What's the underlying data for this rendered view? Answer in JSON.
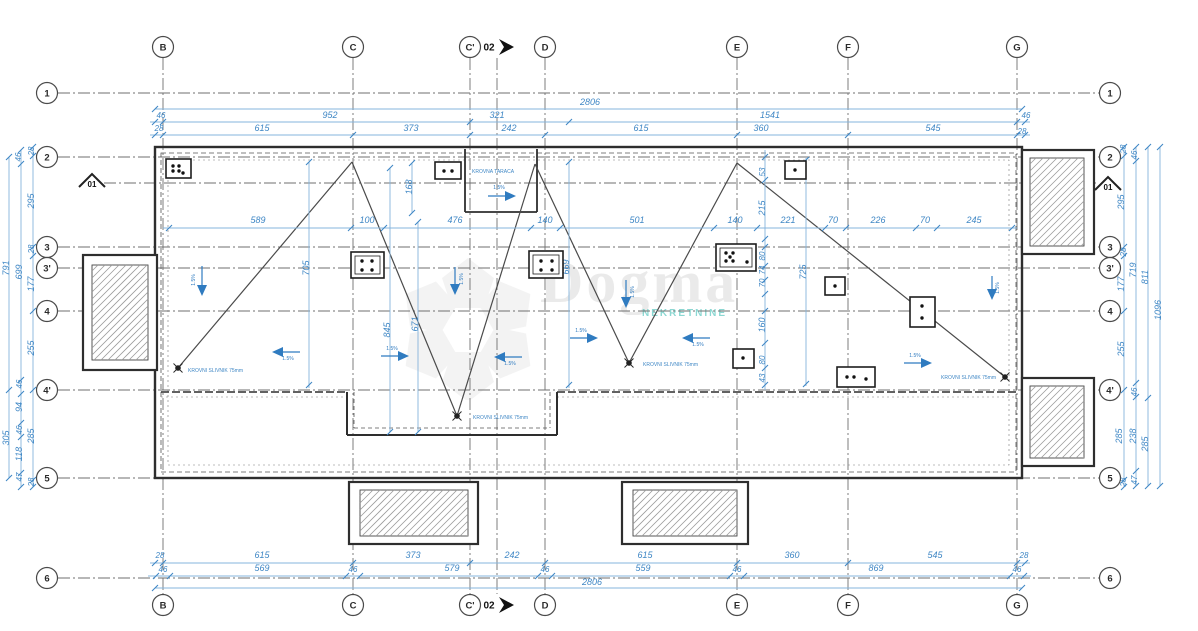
{
  "watermark": {
    "text": "Dogma",
    "subtext": "NEKRETNINE"
  },
  "markers": {
    "section_label": "02",
    "elevation_label": "01",
    "slope_label": "1.5%"
  },
  "colors": {
    "dim_text": "#3f87c5",
    "dim_line": "#85b4dc",
    "arrow": "#2f7bc0",
    "outline": "#2e2e2e",
    "grid": "#6f6f6f",
    "hatch": "#9a9a9a"
  },
  "grid": {
    "columns": [
      {
        "label": "B",
        "x": 163
      },
      {
        "label": "C",
        "x": 353
      },
      {
        "label": "C'",
        "x": 470
      },
      {
        "label": "D",
        "x": 545
      },
      {
        "label": "E",
        "x": 737
      },
      {
        "label": "F",
        "x": 848
      },
      {
        "label": "G",
        "x": 1017
      }
    ],
    "rows": [
      {
        "label": "1",
        "y": 93
      },
      {
        "label": "2",
        "y": 157
      },
      {
        "label": "3",
        "y": 247
      },
      {
        "label": "3'",
        "y": 268
      },
      {
        "label": "4",
        "y": 311
      },
      {
        "label": "4'",
        "y": 390
      },
      {
        "label": "5",
        "y": 478
      },
      {
        "label": "6",
        "y": 578
      }
    ]
  },
  "dimension_labels": [
    {
      "t": "2806",
      "x": 590,
      "y": 105
    },
    {
      "t": "46",
      "x": 161,
      "y": 118,
      "s": 8
    },
    {
      "t": "952",
      "x": 330,
      "y": 118
    },
    {
      "t": "321",
      "x": 497,
      "y": 118
    },
    {
      "t": "1541",
      "x": 770,
      "y": 118
    },
    {
      "t": "46",
      "x": 1026,
      "y": 118,
      "s": 8
    },
    {
      "t": "28",
      "x": 159,
      "y": 131,
      "s": 8
    },
    {
      "t": "615",
      "x": 262,
      "y": 131
    },
    {
      "t": "373",
      "x": 411,
      "y": 131
    },
    {
      "t": "242",
      "x": 509,
      "y": 131
    },
    {
      "t": "615",
      "x": 641,
      "y": 131
    },
    {
      "t": "360",
      "x": 761,
      "y": 131
    },
    {
      "t": "545",
      "x": 933,
      "y": 131
    },
    {
      "t": "28",
      "x": 1022,
      "y": 134,
      "s": 8
    },
    {
      "t": "28",
      "x": 160,
      "y": 558,
      "s": 8
    },
    {
      "t": "615",
      "x": 262,
      "y": 558
    },
    {
      "t": "373",
      "x": 413,
      "y": 558
    },
    {
      "t": "242",
      "x": 512,
      "y": 558
    },
    {
      "t": "615",
      "x": 645,
      "y": 558
    },
    {
      "t": "360",
      "x": 792,
      "y": 558
    },
    {
      "t": "545",
      "x": 935,
      "y": 558
    },
    {
      "t": "28",
      "x": 1024,
      "y": 558,
      "s": 8
    },
    {
      "t": "46",
      "x": 163,
      "y": 572,
      "s": 8
    },
    {
      "t": "569",
      "x": 262,
      "y": 571
    },
    {
      "t": "46",
      "x": 353,
      "y": 572,
      "s": 8
    },
    {
      "t": "579",
      "x": 452,
      "y": 571
    },
    {
      "t": "46",
      "x": 545,
      "y": 572,
      "s": 8
    },
    {
      "t": "559",
      "x": 643,
      "y": 571
    },
    {
      "t": "46",
      "x": 737,
      "y": 572,
      "s": 8
    },
    {
      "t": "869",
      "x": 876,
      "y": 571
    },
    {
      "t": "46",
      "x": 1017,
      "y": 572,
      "s": 8
    },
    {
      "t": "2806",
      "x": 592,
      "y": 585
    },
    {
      "t": "791",
      "x": 9,
      "y": 268,
      "r": -90
    },
    {
      "t": "305",
      "x": 9,
      "y": 438,
      "r": -90
    },
    {
      "t": "699",
      "x": 22,
      "y": 272,
      "r": -90
    },
    {
      "t": "46",
      "x": 22,
      "y": 384,
      "r": -90,
      "s": 8
    },
    {
      "t": "94",
      "x": 22,
      "y": 407,
      "r": -90
    },
    {
      "t": "46",
      "x": 22,
      "y": 430,
      "r": -90,
      "s": 8
    },
    {
      "t": "118",
      "x": 22,
      "y": 454,
      "r": -90
    },
    {
      "t": "47",
      "x": 22,
      "y": 477,
      "r": -90,
      "s": 8
    },
    {
      "t": "46",
      "x": 21,
      "y": 157,
      "r": -90,
      "s": 8
    },
    {
      "t": "28",
      "x": 34,
      "y": 151,
      "r": -90,
      "s": 8
    },
    {
      "t": "295",
      "x": 34,
      "y": 201,
      "r": -90
    },
    {
      "t": "28",
      "x": 34,
      "y": 249,
      "r": -90,
      "s": 8
    },
    {
      "t": "177",
      "x": 34,
      "y": 284,
      "r": -90
    },
    {
      "t": "255",
      "x": 34,
      "y": 348,
      "r": -90
    },
    {
      "t": "285",
      "x": 34,
      "y": 436,
      "r": -90
    },
    {
      "t": "28",
      "x": 34,
      "y": 482,
      "r": -90,
      "s": 8
    },
    {
      "t": "28",
      "x": 1126,
      "y": 149,
      "r": -90,
      "s": 8
    },
    {
      "t": "46",
      "x": 1137,
      "y": 155,
      "r": -90,
      "s": 8
    },
    {
      "t": "295",
      "x": 1124,
      "y": 202,
      "r": -90
    },
    {
      "t": "28",
      "x": 1126,
      "y": 252,
      "r": -90,
      "s": 8
    },
    {
      "t": "177",
      "x": 1124,
      "y": 284,
      "r": -90
    },
    {
      "t": "255",
      "x": 1124,
      "y": 349,
      "r": -90
    },
    {
      "t": "46",
      "x": 1137,
      "y": 392,
      "r": -90,
      "s": 8
    },
    {
      "t": "285",
      "x": 1122,
      "y": 436,
      "r": -90
    },
    {
      "t": "238",
      "x": 1136,
      "y": 436,
      "r": -90
    },
    {
      "t": "285",
      "x": 1148,
      "y": 444,
      "r": -90
    },
    {
      "t": "28",
      "x": 1126,
      "y": 482,
      "r": -90,
      "s": 8
    },
    {
      "t": "47",
      "x": 1137,
      "y": 480,
      "r": -90,
      "s": 8
    },
    {
      "t": "719",
      "x": 1136,
      "y": 270,
      "r": -90
    },
    {
      "t": "811",
      "x": 1148,
      "y": 277,
      "r": -90
    },
    {
      "t": "1096",
      "x": 1161,
      "y": 310,
      "r": -90
    },
    {
      "t": "589",
      "x": 258,
      "y": 223
    },
    {
      "t": "100",
      "x": 367,
      "y": 223
    },
    {
      "t": "476",
      "x": 455,
      "y": 223
    },
    {
      "t": "140",
      "x": 545,
      "y": 223
    },
    {
      "t": "501",
      "x": 637,
      "y": 223
    },
    {
      "t": "140",
      "x": 735,
      "y": 223
    },
    {
      "t": "221",
      "x": 788,
      "y": 223
    },
    {
      "t": "70",
      "x": 833,
      "y": 223
    },
    {
      "t": "226",
      "x": 878,
      "y": 223
    },
    {
      "t": "70",
      "x": 925,
      "y": 223
    },
    {
      "t": "245",
      "x": 974,
      "y": 223
    },
    {
      "t": "168",
      "x": 412,
      "y": 187,
      "r": -90
    },
    {
      "t": "705",
      "x": 309,
      "y": 268,
      "r": -90
    },
    {
      "t": "845",
      "x": 390,
      "y": 330,
      "r": -90
    },
    {
      "t": "671",
      "x": 418,
      "y": 324,
      "r": -90
    },
    {
      "t": "669",
      "x": 569,
      "y": 267,
      "r": -90
    },
    {
      "t": "53",
      "x": 765,
      "y": 172,
      "r": -90,
      "s": 8
    },
    {
      "t": "215",
      "x": 765,
      "y": 208,
      "r": -90
    },
    {
      "t": "80",
      "x": 765,
      "y": 256,
      "r": -90,
      "s": 8
    },
    {
      "t": "74",
      "x": 765,
      "y": 270,
      "r": -90,
      "s": 8
    },
    {
      "t": "70",
      "x": 765,
      "y": 283,
      "r": -90,
      "s": 8
    },
    {
      "t": "160",
      "x": 765,
      "y": 325,
      "r": -90
    },
    {
      "t": "80",
      "x": 765,
      "y": 360,
      "r": -90,
      "s": 8
    },
    {
      "t": "43",
      "x": 765,
      "y": 378,
      "r": -90,
      "s": 8
    },
    {
      "t": "725",
      "x": 806,
      "y": 272,
      "r": -90
    }
  ],
  "annotations": [
    {
      "t": "KROVNI SLIVNIK 75mm",
      "x": 188,
      "y": 372
    },
    {
      "t": "KROVNI SLIVNIK 75mm",
      "x": 473,
      "y": 419
    },
    {
      "t": "KROVNI SLIVNIK 75mm",
      "x": 643,
      "y": 366
    },
    {
      "t": "KROVNI SLIVNIK 75mm",
      "x": 941,
      "y": 379
    },
    {
      "t": "KROVNA TARACA",
      "x": 472,
      "y": 173
    }
  ],
  "slope_arrows": [
    {
      "hx": 202,
      "hy": 296,
      "tx": 202,
      "ty": 266,
      "lx": 195,
      "ly": 280,
      "lr": -90
    },
    {
      "hx": 272,
      "hy": 352,
      "tx": 300,
      "ty": 352,
      "lx": 288,
      "ly": 360,
      "lr": 0
    },
    {
      "hx": 516,
      "hy": 196,
      "tx": 488,
      "ty": 196,
      "lx": 499,
      "ly": 189,
      "lr": 0
    },
    {
      "hx": 409,
      "hy": 356,
      "tx": 381,
      "ty": 356,
      "lx": 392,
      "ly": 350,
      "lr": 0
    },
    {
      "hx": 494,
      "hy": 357,
      "tx": 522,
      "ty": 357,
      "lx": 510,
      "ly": 365,
      "lr": 0
    },
    {
      "hx": 455,
      "hy": 295,
      "tx": 455,
      "ty": 267,
      "lx": 463,
      "ly": 279,
      "lr": -90
    },
    {
      "hx": 626,
      "hy": 308,
      "tx": 626,
      "ty": 280,
      "lx": 634,
      "ly": 292,
      "lr": -90
    },
    {
      "hx": 598,
      "hy": 338,
      "tx": 570,
      "ty": 338,
      "lx": 581,
      "ly": 332,
      "lr": 0
    },
    {
      "hx": 682,
      "hy": 338,
      "tx": 710,
      "ty": 338,
      "lx": 698,
      "ly": 346,
      "lr": 0
    },
    {
      "hx": 932,
      "hy": 363,
      "tx": 904,
      "ty": 363,
      "lx": 915,
      "ly": 357,
      "lr": 0
    },
    {
      "hx": 992,
      "hy": 300,
      "tx": 992,
      "ty": 276,
      "lx": 999,
      "ly": 288,
      "lr": -90
    }
  ],
  "roof_symbols": {
    "drains": [
      [
        178,
        368
      ],
      [
        457,
        416
      ],
      [
        629,
        363
      ],
      [
        1005,
        377
      ]
    ],
    "vents": [
      {
        "x": 166,
        "y": 159,
        "w": 25,
        "h": 19,
        "inner": false,
        "dots": [
          [
            7,
            7
          ],
          [
            13,
            7
          ],
          [
            7,
            12
          ],
          [
            13,
            12
          ],
          [
            17,
            14
          ]
        ]
      },
      {
        "x": 435,
        "y": 162,
        "w": 26,
        "h": 17,
        "inner": false,
        "dots": [
          [
            9,
            9
          ],
          [
            17,
            9
          ]
        ]
      },
      {
        "x": 351,
        "y": 252,
        "w": 33,
        "h": 26,
        "inner": true,
        "dots": [
          [
            11,
            9
          ],
          [
            21,
            9
          ],
          [
            11,
            18
          ],
          [
            21,
            18
          ]
        ]
      },
      {
        "x": 529,
        "y": 251,
        "w": 34,
        "h": 27,
        "inner": true,
        "dots": [
          [
            12,
            10
          ],
          [
            23,
            10
          ],
          [
            12,
            19
          ],
          [
            23,
            19
          ]
        ]
      },
      {
        "x": 716,
        "y": 244,
        "w": 40,
        "h": 27,
        "inner": true,
        "dots": [
          [
            10,
            9
          ],
          [
            17,
            9
          ],
          [
            10,
            17
          ],
          [
            17,
            17
          ],
          [
            14,
            13
          ],
          [
            31,
            18
          ]
        ]
      },
      {
        "x": 785,
        "y": 161,
        "w": 21,
        "h": 18,
        "inner": false,
        "dots": [
          [
            10,
            9
          ]
        ]
      },
      {
        "x": 825,
        "y": 277,
        "w": 20,
        "h": 18,
        "inner": false,
        "dots": [
          [
            10,
            9
          ]
        ]
      },
      {
        "x": 910,
        "y": 297,
        "w": 25,
        "h": 30,
        "inner": false,
        "dots": [
          [
            12,
            9
          ],
          [
            12,
            21
          ]
        ]
      },
      {
        "x": 733,
        "y": 349,
        "w": 21,
        "h": 19,
        "inner": false,
        "dots": [
          [
            10,
            9
          ]
        ]
      },
      {
        "x": 837,
        "y": 367,
        "w": 38,
        "h": 20,
        "inner": false,
        "dots": [
          [
            10,
            10
          ],
          [
            17,
            10
          ],
          [
            29,
            12
          ]
        ]
      }
    ]
  }
}
